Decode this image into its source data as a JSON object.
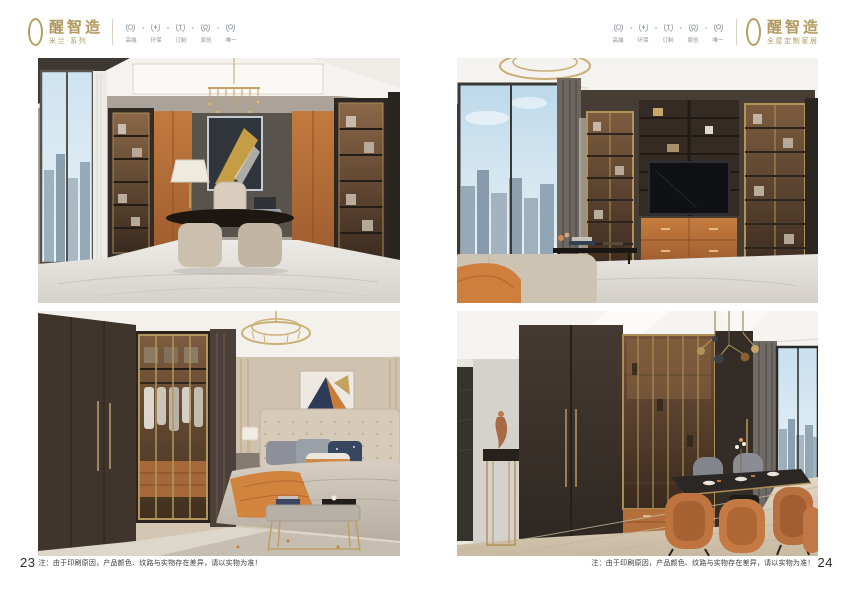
{
  "brand": {
    "mark": "O",
    "name": "醒智造"
  },
  "header_left": {
    "series": "米兰·系列"
  },
  "header_right": {
    "tagline": "全屋定制家居"
  },
  "badges": [
    {
      "label": "高端",
      "icon": "laurel-wreath"
    },
    {
      "label": "环保",
      "icon": "laurel-wreath"
    },
    {
      "label": "订制",
      "icon": "laurel-wreath"
    },
    {
      "label": "原创",
      "icon": "laurel-wreath"
    },
    {
      "label": "唯一",
      "icon": "laurel-wreath"
    }
  ],
  "footers": {
    "left": {
      "page_number": "23",
      "note": "注：由于印刷原因，产品颜色、纹路与实物存在差异，请以实物为准！"
    },
    "right": {
      "page_number": "24",
      "note": "注：由于印刷原因，产品颜色、纹路与实物存在差异，请以实物为准！"
    }
  },
  "photos": [
    {
      "name": "study-room",
      "alt": "Home office: dark desk with beige base, beige office chair, gold chandelier, orange wardrobe doors, lit glass bookcases, city-view window with white curtain, marble floor"
    },
    {
      "name": "tv-wall",
      "alt": "Living room: dark TV wall unit with open shelves, orange drawers under TV, gold-framed glass display cabinets, large city-view window, beige ottoman with orange throw, coffee table with books"
    },
    {
      "name": "bedroom",
      "alt": "Bedroom: dark brown wardrobe with gold-framed glass doors showing clothes and orange drawers, round crystal chandelier, tufted beige headboard, patterned pillows, orange throw, bench with gold legs, geometric artwork"
    },
    {
      "name": "dining-room",
      "alt": "Dining room: dark sideboard with gold-framed glass display and orange drawers, gold pedestal with bronze sculpture, dark dining table with orange leather chairs, modern sputnik chandelier, city-view window"
    }
  ],
  "colors": {
    "logo_gold": "#b19960",
    "badge_gray": "#8d9297",
    "accent_orange": "#c0753e",
    "cabinet_brown": "#3f352d",
    "frame_gold": "#b0945c",
    "text_dark": "#3a3a3a"
  }
}
